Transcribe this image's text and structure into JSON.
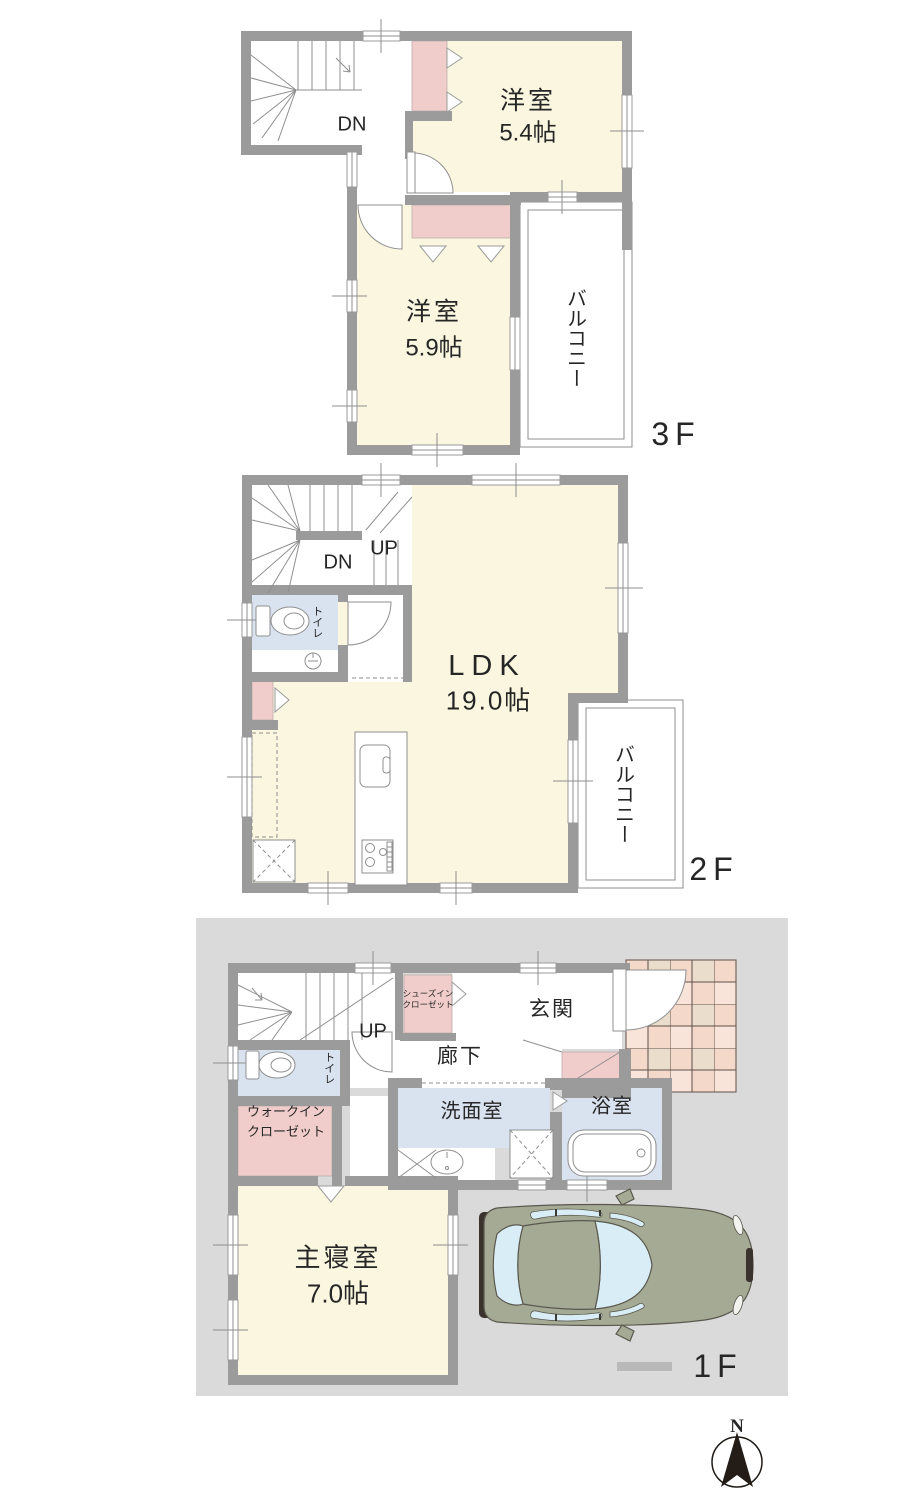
{
  "colors": {
    "wall": "#9b9b9b",
    "room_cream": "#faf6df",
    "closet_pink": "#f0cdca",
    "wet_blue": "#d9e2ef",
    "site_gray": "#dadada",
    "tile_a": "#f4d9cb",
    "tile_b": "#eaddcb",
    "tile_c": "#f9e4d9",
    "tile_line": "#5e5048",
    "line_gray": "#8f8f8f",
    "car_body": "#a5aa95",
    "car_window": "#d8edf5",
    "car_dark": "#3a332d",
    "text": "#262626"
  },
  "floors": {
    "f3": {
      "label": "3F",
      "stair_dn": "DN",
      "room_a_name": "洋室",
      "room_a_size": "5.4帖",
      "room_b_name": "洋室",
      "room_b_size": "5.9帖",
      "balcony": "バルコニー"
    },
    "f2": {
      "label": "2F",
      "stair_dn": "DN",
      "stair_up": "UP",
      "toilet": "トイレ",
      "ldk_name": "LDK",
      "ldk_size": "19.0帖",
      "balcony": "バルコニー"
    },
    "f1": {
      "label": "1F",
      "stair_up": "UP",
      "shoes_closet_1": "シューズイン",
      "shoes_closet_2": "クローゼット",
      "entrance": "玄関",
      "hallway": "廊下",
      "toilet": "トイレ",
      "wic_1": "ウォークイン",
      "wic_2": "クローゼット",
      "washroom": "洗面室",
      "bathroom": "浴室",
      "bedroom_name": "主寝室",
      "bedroom_size": "7.0帖"
    }
  },
  "compass": {
    "north": "N"
  }
}
